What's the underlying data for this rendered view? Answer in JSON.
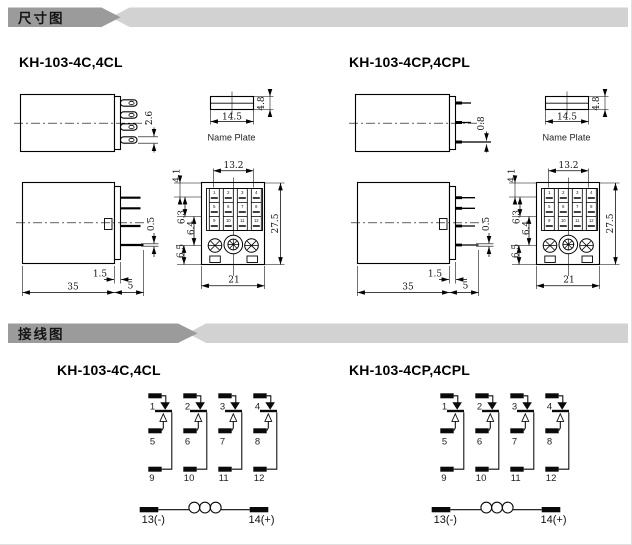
{
  "sections": {
    "dimensions": "尺寸图",
    "wiring": "接线图"
  },
  "models": {
    "c": "KH-103-4C,4CL",
    "cp": "KH-103-4CP,4CPL"
  },
  "dims": {
    "blade_thickness": "2.6",
    "pin_diameter": "0.8",
    "plate_width": "14.5",
    "plate_height": "4.8",
    "plate_label": "Name Plate",
    "body_length": "35",
    "pin_length": "5",
    "flange_width": "1.5",
    "pin_thickness": "0.5",
    "terminal_span": "13.2",
    "seg_top": "4.1",
    "seg_row": "6.3",
    "seg_mid": "6.4",
    "seg_bottom": "6.5",
    "socket_height": "27.5",
    "socket_width": "21"
  },
  "terminals": [
    "1",
    "2",
    "3",
    "4",
    "5",
    "6",
    "7",
    "8",
    "9",
    "10",
    "11",
    "12"
  ],
  "coil": {
    "negative": "13(-)",
    "positive": "14(+)"
  },
  "colors": {
    "banner_dark": "#9b9b9b",
    "banner_light": "#d2d2d2",
    "ink": "#000000"
  }
}
